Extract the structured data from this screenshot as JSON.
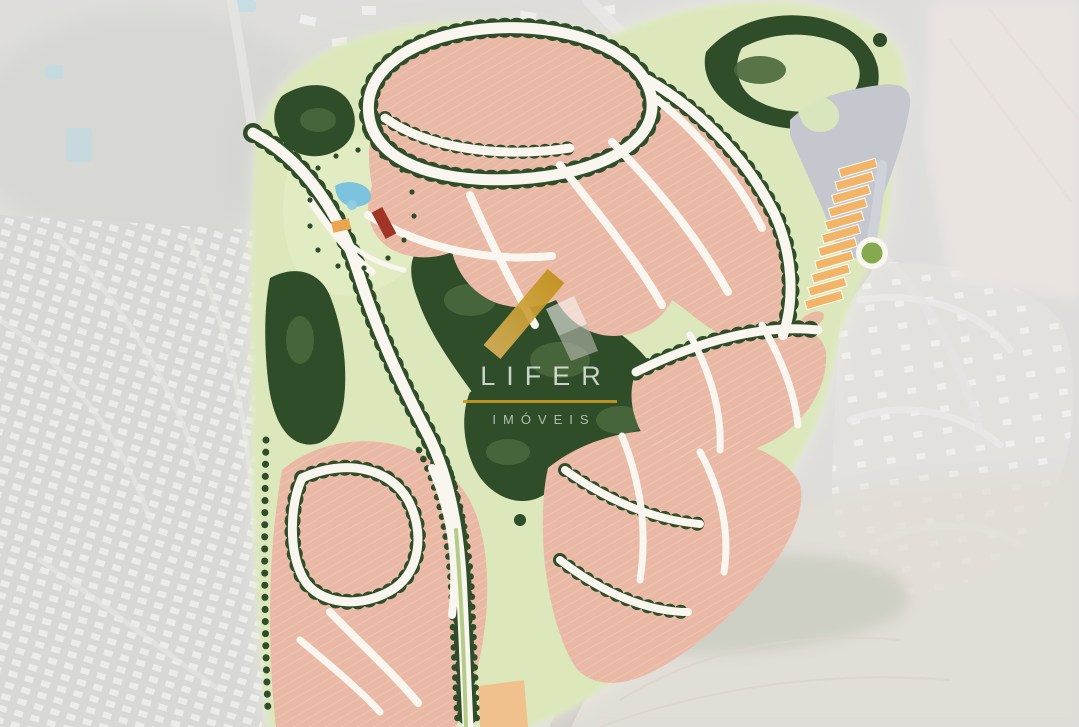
{
  "image": {
    "title": "Residential development master plan overlaid on faded aerial photograph",
    "type": "site-master-plan"
  },
  "watermark": {
    "brand": "LIFER",
    "tagline": "IMÓVEIS"
  },
  "colors": {
    "aerial_base": "#c8c7c3",
    "plan_halo": "#f7f5ec",
    "plan_open_green": "#dce8bb",
    "club_lawn_green": "#e2ecc3",
    "forest_green": "#2f4d28",
    "forest_light": "#4a683c",
    "residential_lot": "#e9b9a6",
    "residential_lot_line": "#ffffff",
    "road_white": "#f8f6ee",
    "median_green": "#b4cc88",
    "commercial_gray": "#c4c7cd",
    "commercial_lot_orange": "#f2b568",
    "tan_block": "#f0c08d",
    "roundabout_green": "#84a94e",
    "pool_blue": "#7cc3dd",
    "clubhouse_roof_red": "#a03527",
    "court_orange": "#e9a64f",
    "existing_road_gray": "#c6c3be",
    "watermark_gold": "#c99a1f",
    "watermark_text": "#ffffff"
  }
}
